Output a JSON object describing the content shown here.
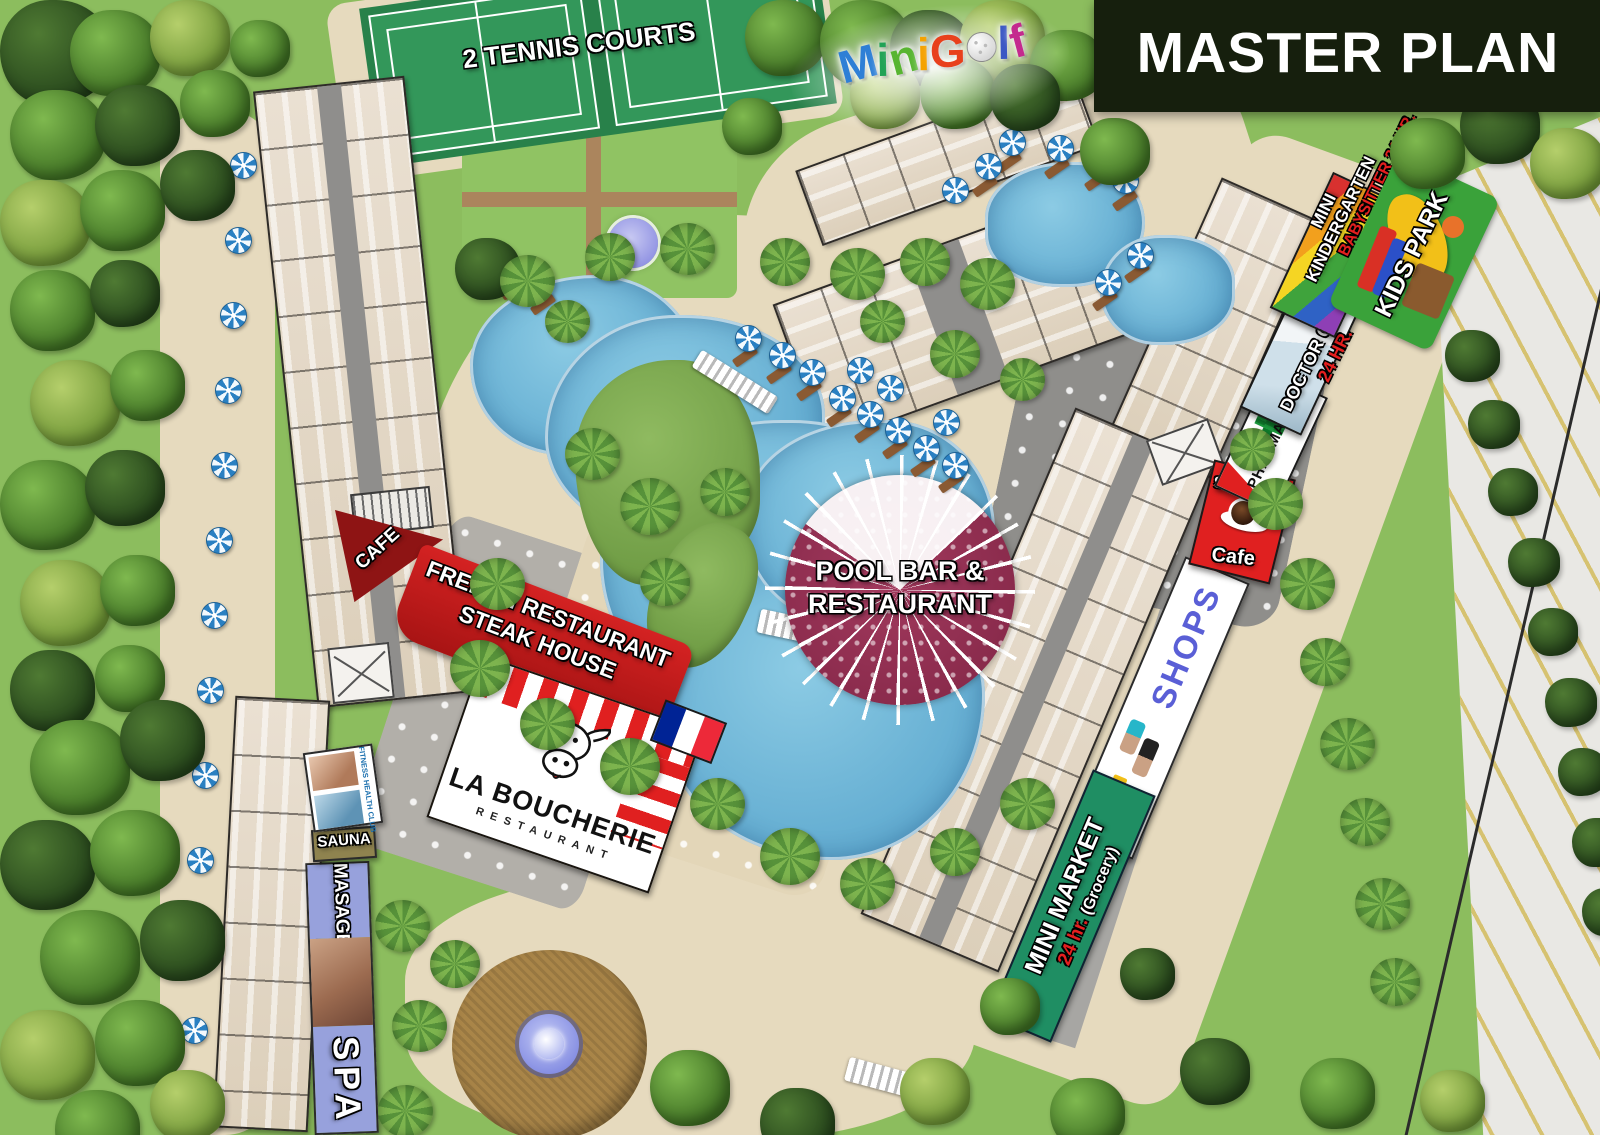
{
  "title": "MASTER PLAN",
  "minigolf": {
    "letters": [
      {
        "ch": "M",
        "color": "#2e7fd6"
      },
      {
        "ch": "i",
        "color": "#21a356"
      },
      {
        "ch": "n",
        "color": "#58b531"
      },
      {
        "ch": "i",
        "color": "#f5a200"
      },
      {
        "ch": " ",
        "color": ""
      },
      {
        "ch": "G",
        "color": "#e8401c"
      },
      {
        "ch": "o",
        "color": "ball"
      },
      {
        "ch": "l",
        "color": "#3b57c4"
      },
      {
        "ch": "f",
        "color": "#c42a8e"
      }
    ]
  },
  "labels": {
    "tennis": "2 TENNIS COURTS",
    "pool_bar_line1": "POOL BAR &",
    "pool_bar_line2": "RESTAURANT",
    "french_line1": "FRENCH RESTAURANT",
    "french_line2": "STEAK HOUSE",
    "boucherie_name": "LA BOUCHERIE",
    "boucherie_sub": "RESTAURANT",
    "cafe_triangle": "CAFE",
    "fitness": "FITNESS HEALTH CLUB",
    "sauna": "SAUNA",
    "masage": "MASAGE",
    "spa": "SPA",
    "shops": "SHOPS",
    "mini_market": "MINI MARKET",
    "mini_market_hours": "24 hr.",
    "mini_market_sub": "(Grocery)",
    "sandwich": "Sandwich",
    "cafe": "Cafe",
    "pharmacy": "PHARMACY",
    "doctor_clinic": "DOCTOR CLINIC",
    "doctor_hours": "24 HR.",
    "kindergarten_line1": "MINI",
    "kindergarten_line2": "KINDERGARTEN",
    "babysitter": "BABYSITTER 24 HR.",
    "kids_park": "KIDS PARK"
  },
  "colors": {
    "grass": "#8cbd5e",
    "sand": "#e6dabe",
    "pool_water": "#5ea9cf",
    "pool_bar_maroon": "#87294a",
    "banner_red": "#cf1f1f",
    "cafe_triangle_red": "#8e1414",
    "mini_market_green": "#1f8e63",
    "spa_periwinkle": "#97a1dc",
    "sauna_olive": "#8f834f",
    "shops_blue": "#5a5fd6",
    "pharmacy_green": "#1c9a3d",
    "master_plan_bg": "#161f0d"
  }
}
